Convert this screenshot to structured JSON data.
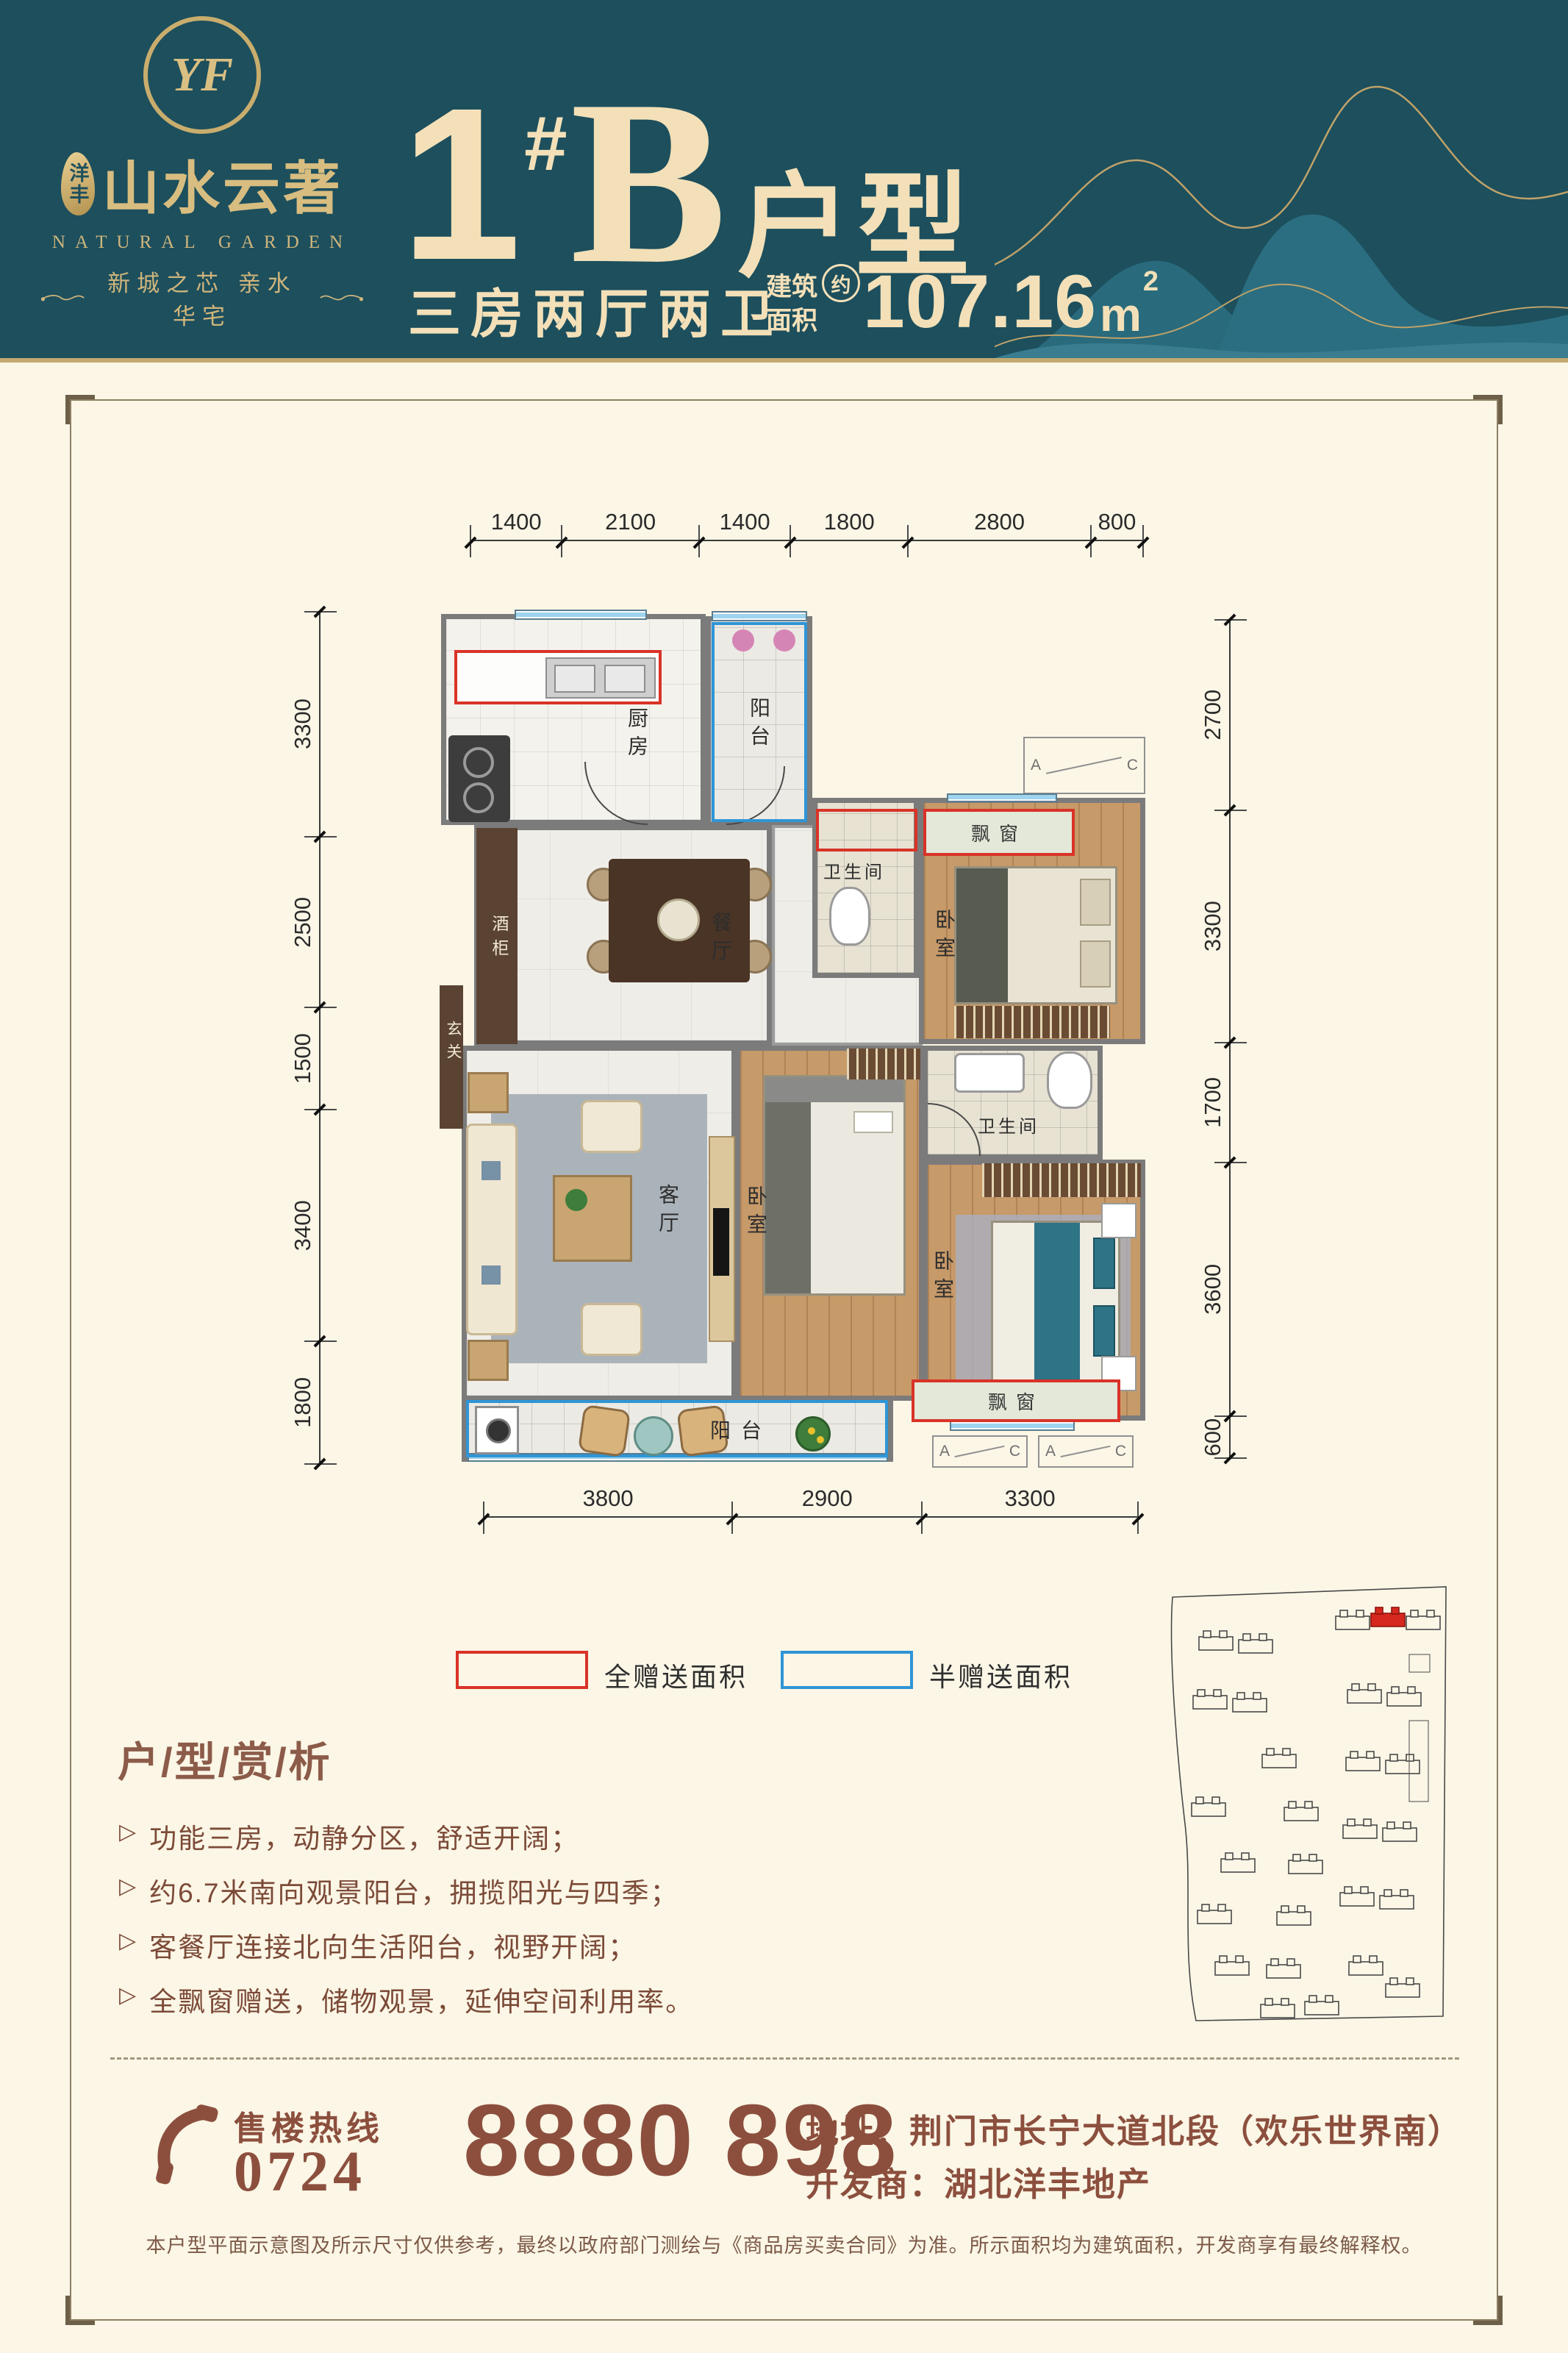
{
  "header": {
    "logo_mark": "YF",
    "logo_seal": "洋丰",
    "logo_name": "山水云著",
    "logo_en": "NATURAL GARDEN",
    "tagline": "新城之芯  亲水华宅",
    "unit_number": "1",
    "unit_hash": "#",
    "unit_letter": "B",
    "unit_suffix": "户型",
    "layout_text": "三房两厅两卫",
    "area_label_line1": "建筑",
    "area_label_line2": "面积",
    "area_approx": "约",
    "area_value": "107.16",
    "area_unit": "m",
    "area_exponent": "2"
  },
  "plan": {
    "dims_top": [
      "1400",
      "2100",
      "1400",
      "1800",
      "2800",
      "800"
    ],
    "dims_bottom": [
      "3800",
      "2900",
      "3300"
    ],
    "dims_left": [
      "3300",
      "2500",
      "1500",
      "3400",
      "1800"
    ],
    "dims_right": [
      "2700",
      "3300",
      "1700",
      "3600",
      "600"
    ],
    "rooms": {
      "kitchen": "厨房",
      "balcony_north": "阳台",
      "bath_1": "卫生间",
      "bedroom_1": "卧室",
      "bay_1": "飘窗",
      "dining": "餐厅",
      "wine_cabinet": "酒柜",
      "foyer": "玄关",
      "living": "客厅",
      "bedroom_2": "卧室",
      "bath_2": "卫生间",
      "bedroom_3": "卧室",
      "bay_2": "飘窗",
      "balcony_south": "阳台"
    },
    "ac_a": "A",
    "ac_c": "C"
  },
  "legend": {
    "full_gift_label": "全赠送面积",
    "half_gift_label": "半赠送面积"
  },
  "analysis": {
    "title": "户/型/赏/析",
    "items": [
      "功能三房，动静分区，舒适开阔；",
      "约6.7米南向观景阳台，拥揽阳光与四季；",
      "客餐厅连接北向生活阳台，视野开阔；",
      "全飘窗赠送，储物观景，延伸空间利用率。"
    ]
  },
  "footer": {
    "hotline_label": "售楼热线",
    "hotline_prefix": "0724",
    "hotline_number": "8880 898",
    "address_label": "地址：",
    "address_value": "荆门市长宁大道北段（欢乐世界南）",
    "developer_label": "开发商：",
    "developer_value": "湖北洋丰地产",
    "disclaimer": "本户型平面示意图及所示尺寸仅供参考，最终以政府部门测绘与《商品房买卖合同》为准。所示面积均为建筑面积，开发商享有最终解释权。"
  },
  "colors": {
    "header_teal": "#1d4f5d",
    "gold": "#c3a96f",
    "cream_text": "#f3e0b8",
    "body_cream": "#fbf6e6",
    "full_gift_red": "#d93328",
    "half_gift_blue": "#2f95d6",
    "brown_text": "#8c4f3e",
    "site_highlight": "#d6281e"
  }
}
